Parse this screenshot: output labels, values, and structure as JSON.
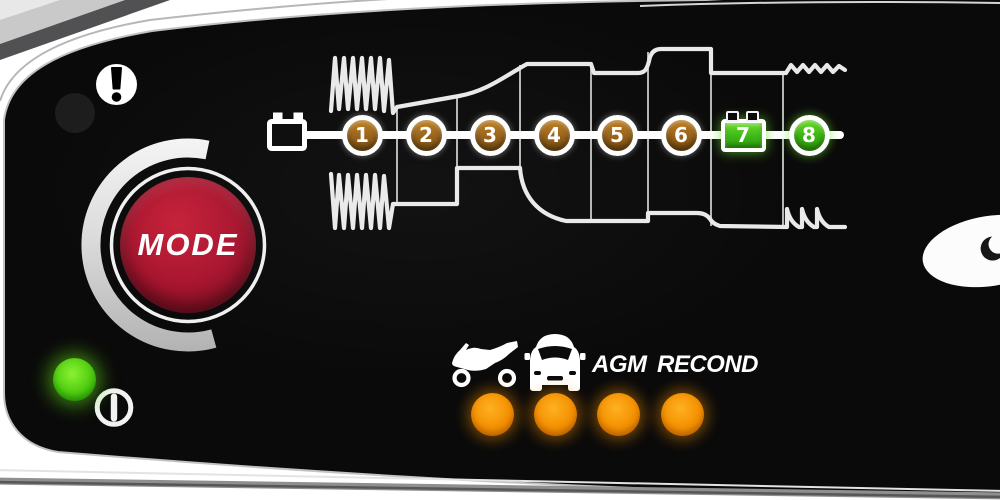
{
  "panel": {
    "type": "battery-charger-control-panel",
    "colors": {
      "panel_black": "#0a0a0a",
      "frame_white": "#ffffff",
      "button_red": "#a8142e",
      "step_amber": "#9c651a",
      "step_green": "#3fbb16",
      "led_orange": "#f39000",
      "led_green": "#4ecb10"
    }
  },
  "indicators": {
    "error": {
      "icon": "warning-icon",
      "led_state": "off"
    },
    "power": {
      "icon": "power-icon",
      "led_state": "on"
    }
  },
  "mode_button": {
    "label": "MODE"
  },
  "charging_stages": {
    "source_icon": "battery-icon",
    "steps": [
      {
        "label": "1",
        "state": "amber",
        "shape": "circle"
      },
      {
        "label": "2",
        "state": "amber",
        "shape": "circle"
      },
      {
        "label": "3",
        "state": "amber",
        "shape": "circle"
      },
      {
        "label": "4",
        "state": "amber",
        "shape": "circle"
      },
      {
        "label": "5",
        "state": "amber",
        "shape": "circle"
      },
      {
        "label": "6",
        "state": "amber",
        "shape": "circle"
      },
      {
        "label": "7",
        "state": "green",
        "shape": "battery"
      },
      {
        "label": "8",
        "state": "green",
        "shape": "circle"
      }
    ]
  },
  "mode_options": [
    {
      "icon": "motorcycle-icon",
      "label": "",
      "led_state": "on"
    },
    {
      "icon": "car-icon",
      "label": "",
      "led_state": "on"
    },
    {
      "icon": "",
      "label": "AGM",
      "led_state": "on"
    },
    {
      "icon": "",
      "label": "RECOND",
      "led_state": "on"
    }
  ]
}
